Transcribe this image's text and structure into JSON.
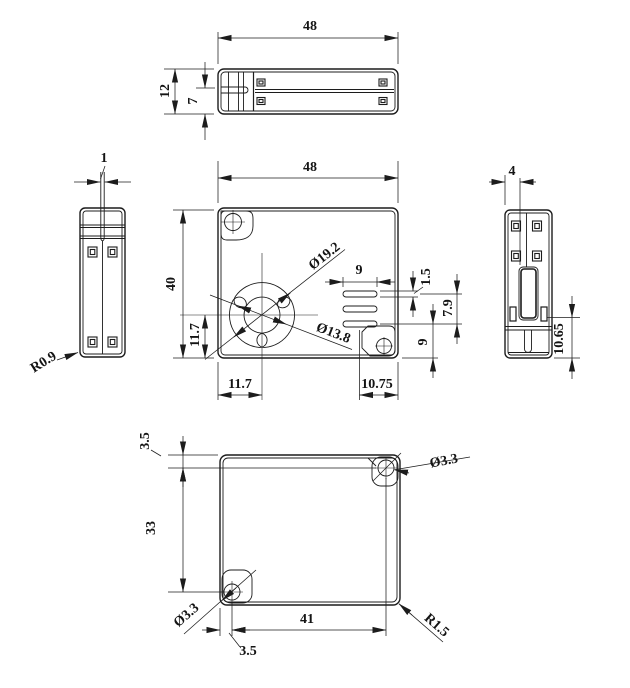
{
  "drawing": {
    "top_view": {
      "width_48": "48",
      "height_12": "12",
      "rail_7": "7"
    },
    "left_view": {
      "gap_1": "1",
      "radius_r09": "R0.9"
    },
    "front_view": {
      "width_48": "48",
      "height_40": "40",
      "fan_outer": "Ø19.2",
      "fan_inner": "Ø13.8",
      "vent_width_9": "9",
      "vent_slot_15": "1.5",
      "vent_span_79": "7.9",
      "vent_bottom_9": "9",
      "fan_y_117": "11.7",
      "fan_x_117": "11.7",
      "vent_right_1075": "10.75"
    },
    "right_view": {
      "depth_4": "4",
      "bottom_1065": "10.65"
    },
    "bottom_view": {
      "hole_top_35": "3.5",
      "span_v_33": "33",
      "dia_tr": "Ø3.3",
      "dia_bl": "Ø3.3",
      "span_h_41": "41",
      "corner_r15": "R1.5",
      "hole_left_35": "3.5"
    }
  }
}
